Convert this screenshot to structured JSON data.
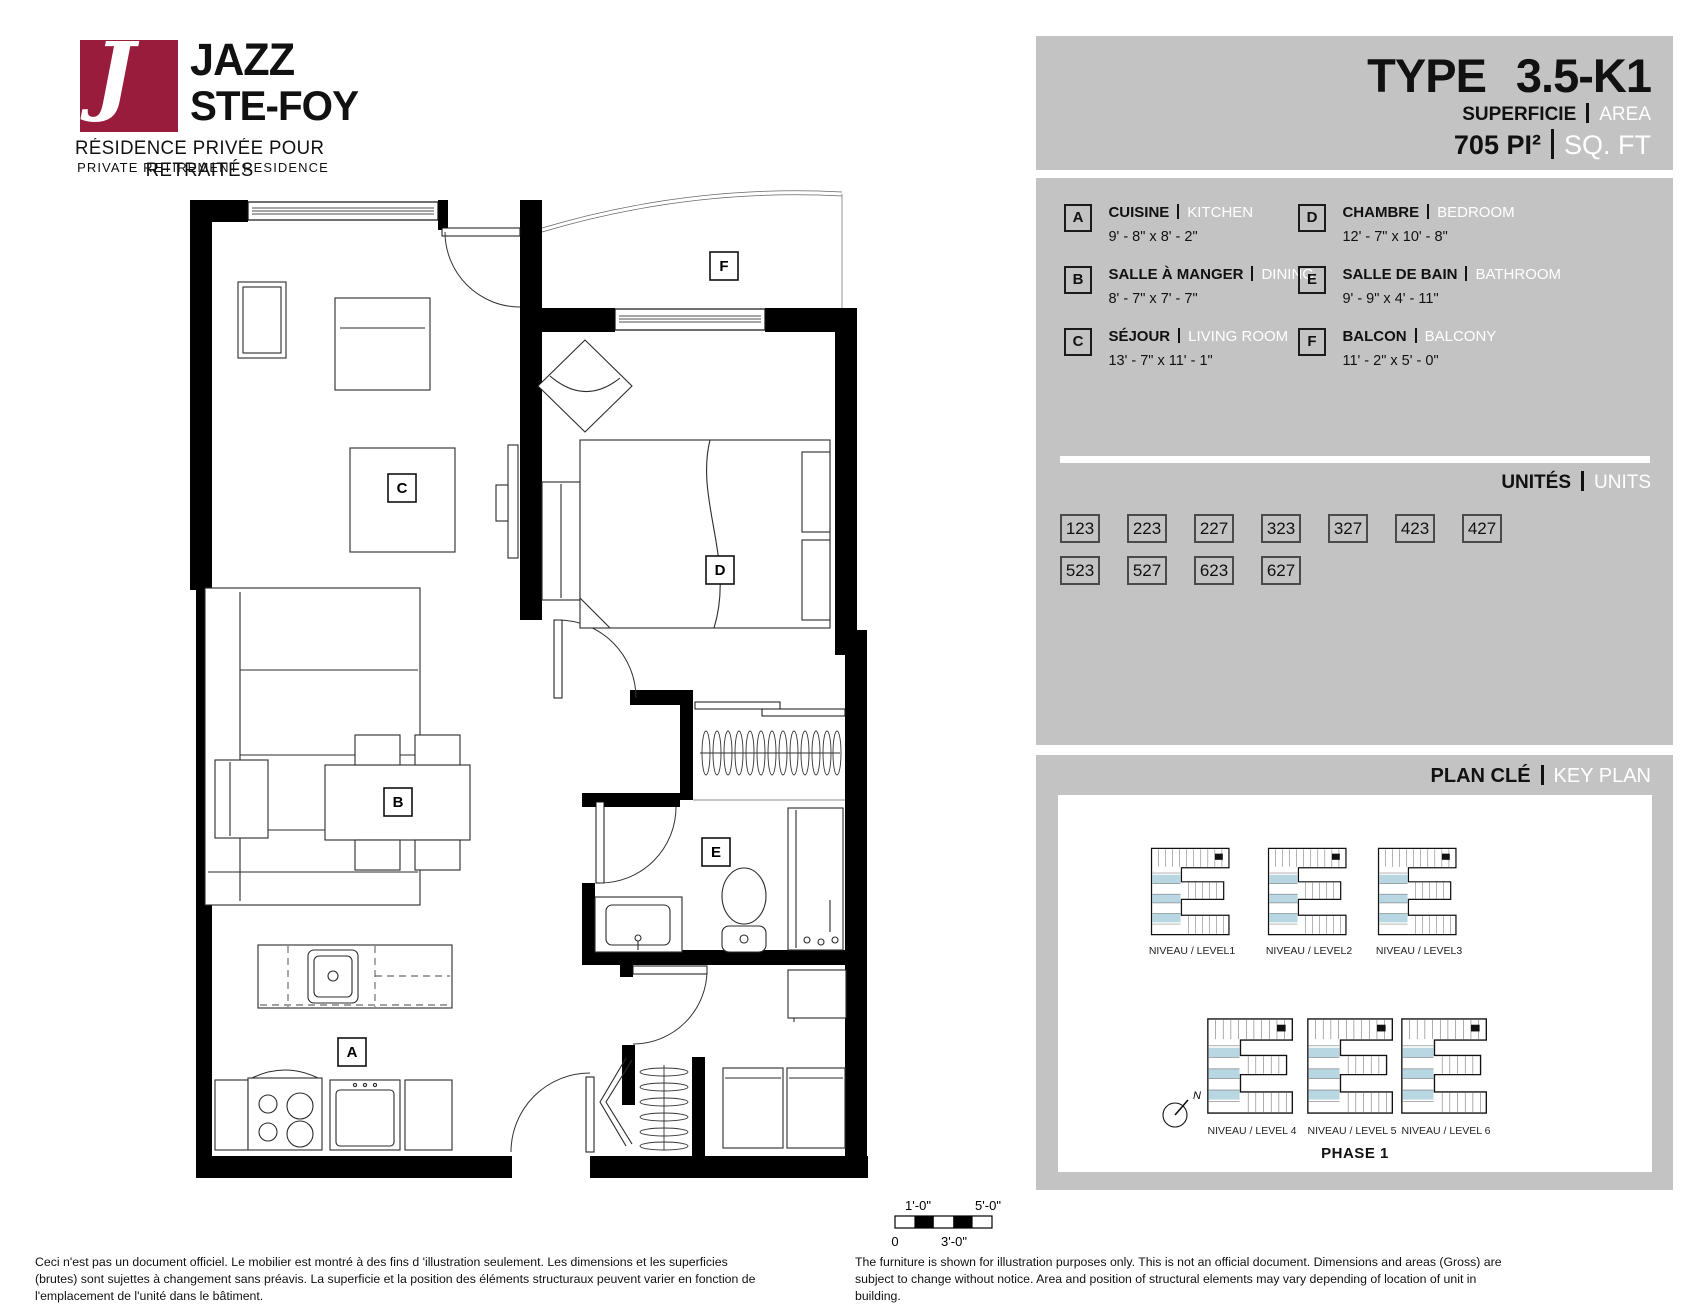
{
  "logo": {
    "monogram": "J",
    "brand_line1": "JAZZ",
    "brand_line2": "STE-FOY",
    "tagline_fr": "RÉSIDENCE PRIVÉE POUR RETRAITÉS",
    "tagline_en": "PRIVATE RETIREMENT RESIDENCE",
    "brand_color": "#9a1c3c"
  },
  "colors": {
    "panel_gray": "#c3c3c3"
  },
  "header": {
    "type_label": "TYPE",
    "type_value": "3.5-K1",
    "area_label_fr": "SUPERFICIE",
    "area_label_en": "AREA",
    "area_value": "705",
    "area_unit_fr": "PI²",
    "area_unit_en": "SQ. FT"
  },
  "legend": {
    "rooms": [
      {
        "key": "A",
        "name_fr": "CUISINE",
        "name_en": "KITCHEN",
        "dims": "9' - 8\" x 8' - 2\""
      },
      {
        "key": "B",
        "name_fr": "SALLE À MANGER",
        "name_en": "DINING",
        "dims": "8' - 7\" x 7' - 7\""
      },
      {
        "key": "C",
        "name_fr": "SÉJOUR",
        "name_en": "LIVING ROOM",
        "dims": "13' - 7\" x 11' - 1\""
      },
      {
        "key": "D",
        "name_fr": "CHAMBRE",
        "name_en": "BEDROOM",
        "dims": "12' - 7\" x 10' - 8\""
      },
      {
        "key": "E",
        "name_fr": "SALLE DE BAIN",
        "name_en": "BATHROOM",
        "dims": "9' - 9\" x 4' - 11\""
      },
      {
        "key": "F",
        "name_fr": "BALCON",
        "name_en": "BALCONY",
        "dims": "11' - 2\" x 5' - 0\""
      }
    ]
  },
  "units": {
    "label_fr": "UNITÉS",
    "label_en": "UNITS",
    "numbers": [
      "123",
      "223",
      "227",
      "323",
      "327",
      "423",
      "427",
      "523",
      "527",
      "623",
      "627"
    ]
  },
  "key_plan": {
    "label_fr": "PLAN CLÉ",
    "label_en": "KEY PLAN",
    "levels": [
      "NIVEAU / LEVEL1",
      "NIVEAU / LEVEL2",
      "NIVEAU / LEVEL3",
      "NIVEAU / LEVEL 4",
      "NIVEAU / LEVEL 5",
      "NIVEAU / LEVEL 6"
    ],
    "phase": "PHASE 1",
    "compass": "N",
    "highlight_color": "#b9d7e2"
  },
  "floor_plan": {
    "scale_bar": {
      "top_left": "1'-0\"",
      "top_right": "5'-0\"",
      "bottom_left": "0",
      "bottom_mid": "3'-0\""
    }
  },
  "footer": {
    "disclaimer_fr": "Ceci n'est pas un document officiel.  Le mobilier est montré à des fins d 'illustration seulement.  Les dimensions et les superficies (brutes) sont sujettes à changement sans préavis. La superficie et la position des éléments structuraux peuvent varier en fonction de l'emplacement de l'unité dans le bâtiment.",
    "disclaimer_en": "The furniture is shown for illustration purposes only.  This is not an official document.  Dimensions and areas (Gross) are subject to change without notice.  Area and position of structural elements may vary depending of location of unit in building."
  }
}
